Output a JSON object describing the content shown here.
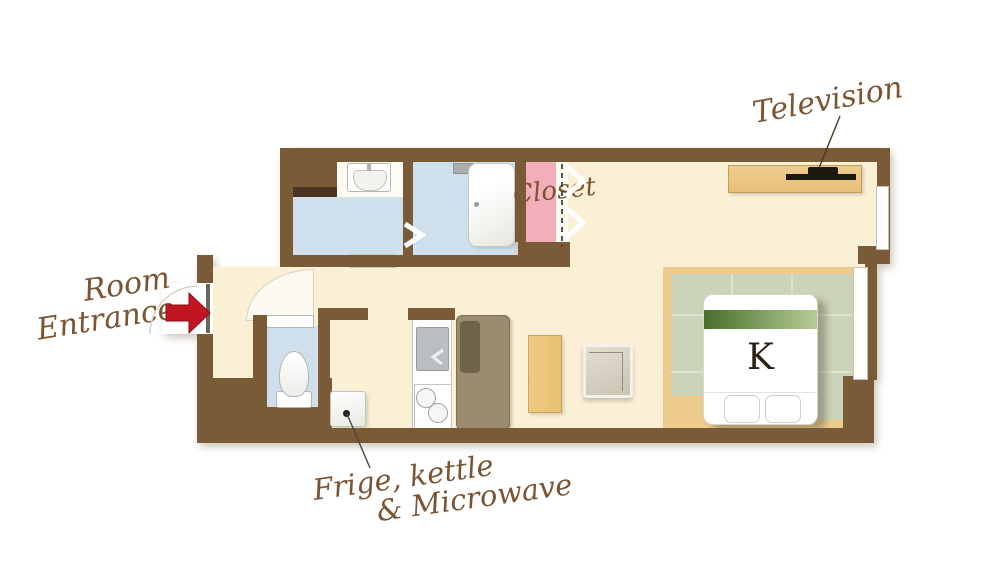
{
  "title": "Room floor plan",
  "labels": {
    "television": "Television",
    "room_entrance": {
      "line1": "Room",
      "line2": "Entrance"
    },
    "closet": "Closet",
    "fridge": {
      "line1": "Frige, kettle",
      "line2": "& Microwave"
    },
    "bed_type": "K"
  },
  "icons": {
    "entrance_arrow": "red right-arrow (css/svg polygon)",
    "television": "black tv top-view bar on wood board",
    "washbasin": "rounded sink with faucet",
    "bathtub": "rounded white tub",
    "toilet": "bowl + tank top-view",
    "stove": "two burner circles",
    "closet_doors": "white chevrons with dashed track",
    "door_swing": "white quarter-circle arc"
  },
  "colors": {
    "wall": "#7a5b38",
    "floor": "#faf0d6",
    "water_blue": "#cfe0ec",
    "closet_pink": "#f2afba",
    "wood_tan": "#ecc584",
    "tatami_green": "#cbd3b8",
    "bed_runner_dark": "#48702a",
    "bed_runner_light": "#b6cb95",
    "label_brown": "#7b5433",
    "arrow_red": "#c11622",
    "tv_black": "#1d1712",
    "cabinet_taupe": "#9c8c6f"
  }
}
